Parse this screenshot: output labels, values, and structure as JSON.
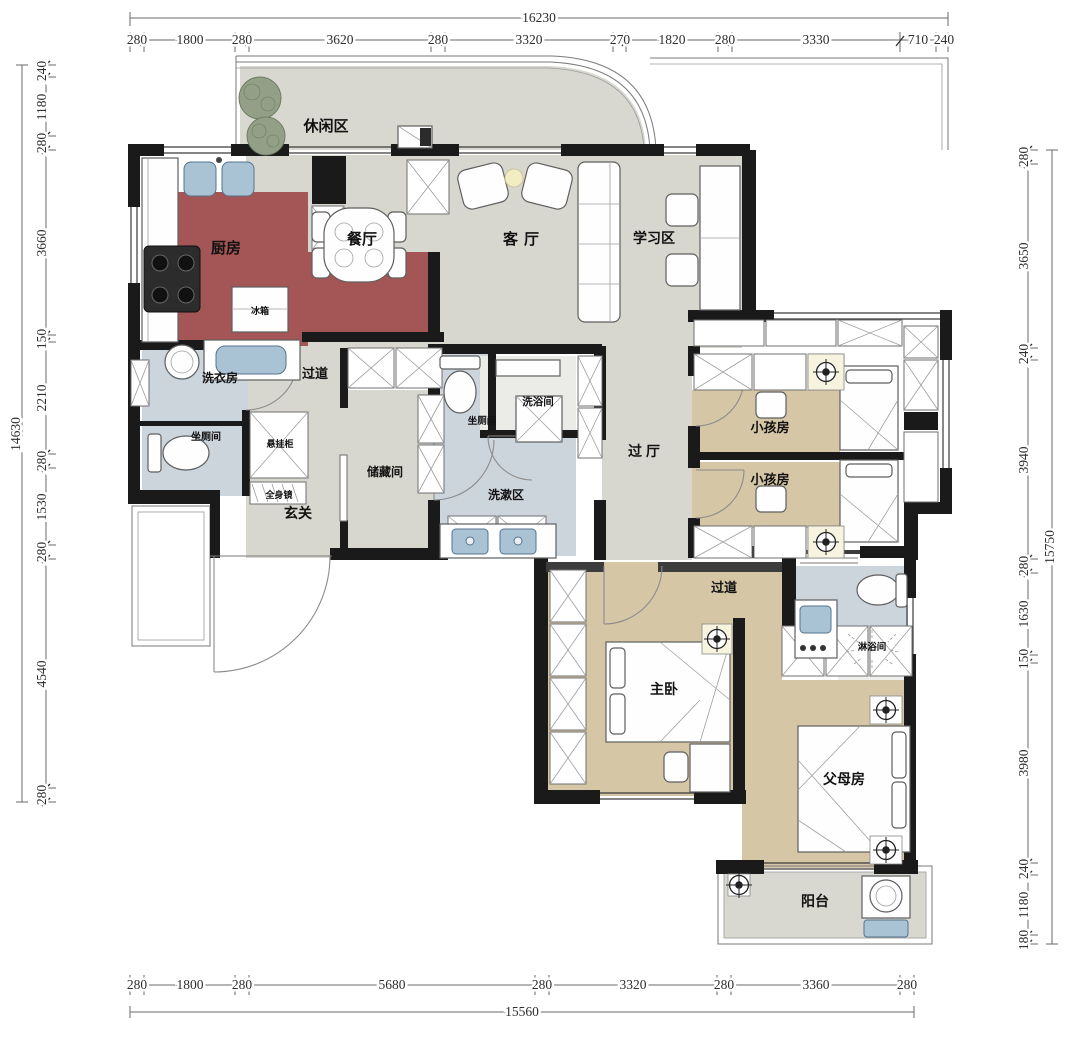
{
  "plan": {
    "rooms": {
      "leisure": "休闲区",
      "kitchen": "厨房",
      "dining": "餐厅",
      "living": "客厅",
      "study": "学习区",
      "laundry": "洗衣房",
      "corridor_upper": "过道",
      "toilet_left": "坐厕间",
      "cabinet_hanging": "悬挂柜",
      "mirror": "全身镜",
      "entry": "玄关",
      "storage": "储藏间",
      "toilet_mid": "坐厕间",
      "bath_mid": "洗浴间",
      "wash_area": "洗漱区",
      "hall": "过厅",
      "kids_room_1": "小孩房",
      "kids_room_2": "小孩房",
      "corridor_lower": "过道",
      "master": "主卧",
      "parents": "父母房",
      "shower": "淋浴间",
      "balcony": "阳台",
      "fridge": "冰箱"
    },
    "dimensions": {
      "top": {
        "total": "16230",
        "segments": [
          "280",
          "1800",
          "280",
          "3620",
          "280",
          "3320",
          "270",
          "1820",
          "280",
          "3330",
          "710",
          "240"
        ]
      },
      "left": {
        "total": "14630",
        "segments": [
          "240",
          "1180",
          "280",
          "3660",
          "150",
          "2210",
          "280",
          "1530",
          "280",
          "4540",
          "280"
        ]
      },
      "right": {
        "total": "15750",
        "segments": [
          "280",
          "3650",
          "240",
          "3940",
          "280",
          "1630",
          "150",
          "3980",
          "240",
          "1180",
          "180"
        ]
      },
      "bottom": {
        "total": "15560",
        "segments": [
          "280",
          "1800",
          "280",
          "5680",
          "280",
          "3320",
          "280",
          "3360",
          "280"
        ]
      }
    },
    "colors": {
      "wall": "#1a1a1a",
      "floor_main": "#d8d7cf",
      "floor_bedroom": "#d5c6a6",
      "floor_bath": "#ccd4dc",
      "floor_kitchen": "#a45656",
      "floor_balcony": "#d9d8d0"
    }
  }
}
